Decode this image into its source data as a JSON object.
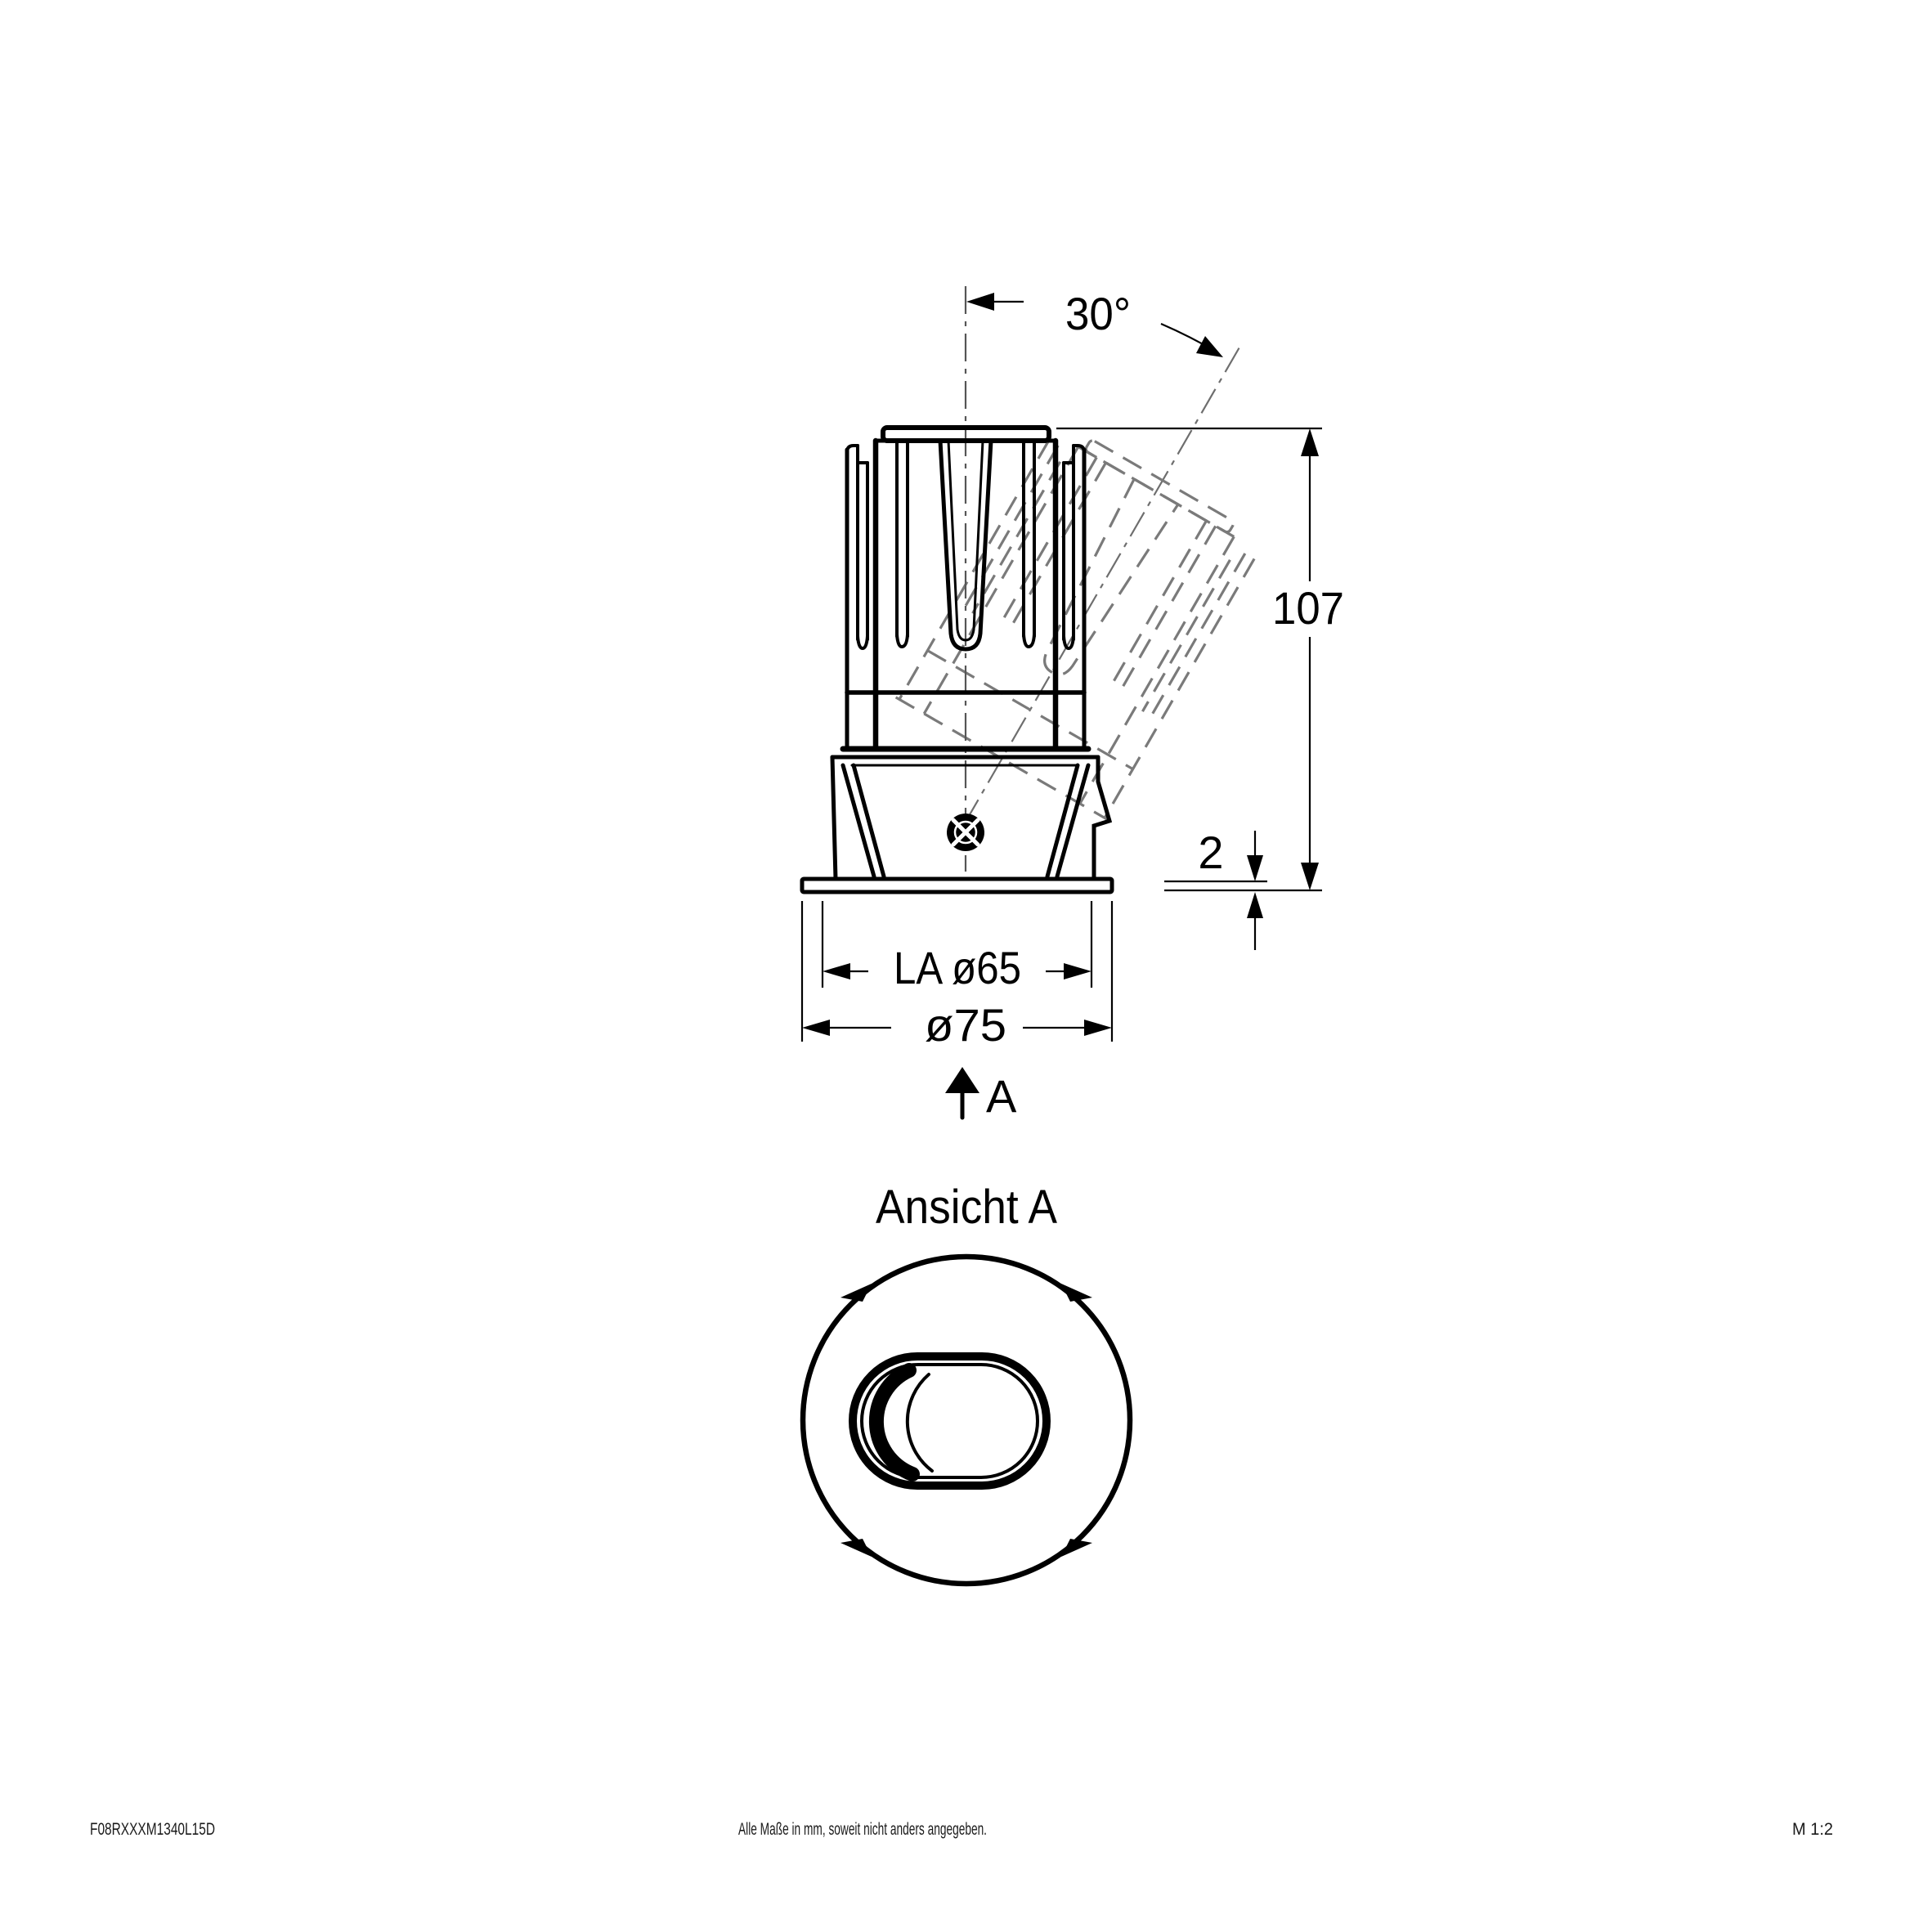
{
  "drawing": {
    "front_view": {
      "angle": "30°",
      "overall_height": "107",
      "flange_thickness": "2",
      "cutout_diameter": "LA ø65",
      "bezel_diameter": "ø75",
      "view_arrow": "A"
    },
    "bottom_view": {
      "title": "Ansicht A"
    },
    "footer": {
      "part_number": "F08RXXXM1340L15D",
      "note": "Alle Maße in mm, soweit nicht anders angegeben.",
      "scale": "M 1:2"
    },
    "colors": {
      "line": "#000000",
      "hidden_line": "#7a7a7a",
      "background": "#ffffff"
    }
  }
}
